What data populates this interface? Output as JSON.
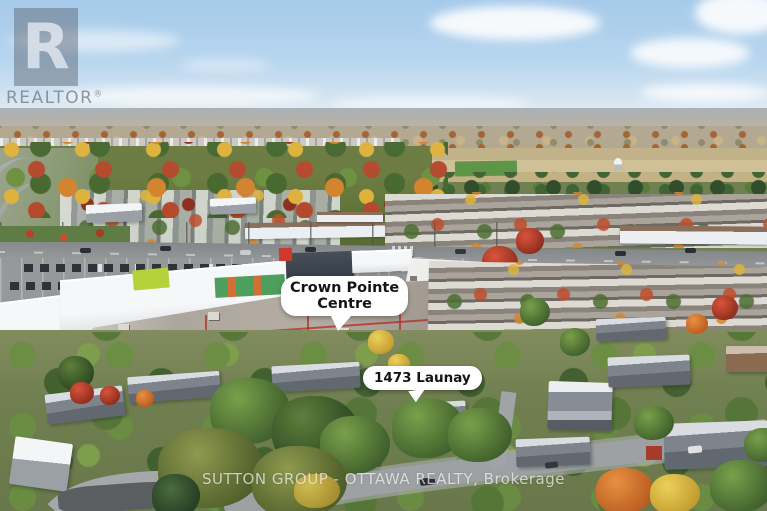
{
  "labels": {
    "crown_pointe": {
      "line1": "Crown Pointe",
      "line2": "Centre"
    },
    "launay": {
      "text": "1473 Launay"
    }
  },
  "watermarks": {
    "realtor": {
      "logo_letter": "R",
      "text": "REALTOR",
      "registered": "®"
    },
    "brokerage": "SUTTON GROUP - OTTAWA REALTY, Brokerage"
  },
  "colors": {
    "sky_top": "#a3c9e9",
    "autumn_orange": "#d3832e",
    "autumn_red": "#b5492c",
    "forest_green": "#54692f",
    "label_background": "#ffffff",
    "label_text": "#141414",
    "watermark_white": "#ffffff",
    "realtor_gray": "#5c6674"
  }
}
